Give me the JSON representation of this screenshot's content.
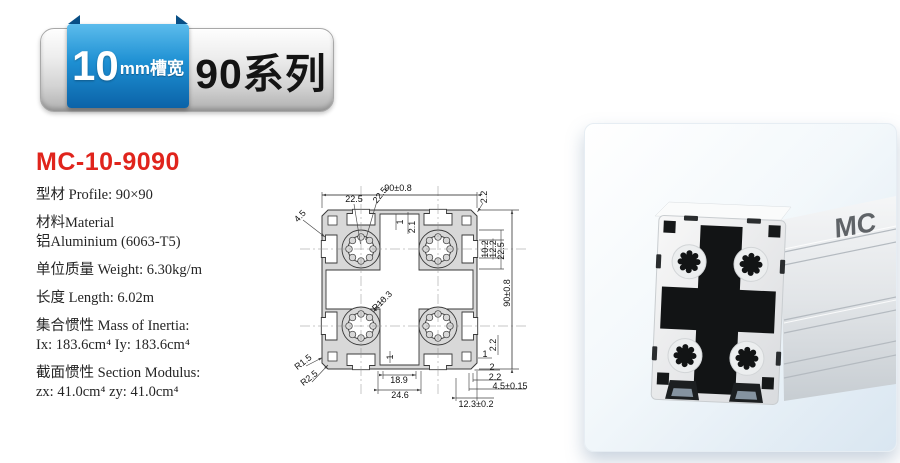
{
  "header": {
    "slot_badge": {
      "number": "10",
      "suffix": "mm槽宽"
    },
    "series": "90系列"
  },
  "product": {
    "model": "MC-10-9090",
    "specs": [
      {
        "lines": [
          "型材 Profile: 90×90"
        ]
      },
      {
        "lines": [
          "材料Material",
          "铝Aluminium (6063-T5)"
        ]
      },
      {
        "lines": [
          "单位质量 Weight: 6.30kg/m"
        ]
      },
      {
        "lines": [
          "长度 Length: 6.02m"
        ]
      },
      {
        "lines": [
          "集合惯性 Mass of Inertia:",
          "Ix: 183.6cm⁴  Iy: 183.6cm⁴"
        ]
      },
      {
        "lines": [
          "截面惯性 Section Modulus:",
          "zx: 41.0cm⁴  zy: 41.0cm⁴"
        ]
      }
    ]
  },
  "drawing": {
    "dimensions": [
      {
        "text": "90±0.8",
        "x": 110,
        "y": 20,
        "rot": 0
      },
      {
        "text": "22.5",
        "x": 66,
        "y": 31,
        "rot": 0
      },
      {
        "text": "22.5",
        "x": 92,
        "y": 27,
        "rot": -52
      },
      {
        "text": "4.5",
        "x": 12,
        "y": 48,
        "rot": -47
      },
      {
        "text": "2.2",
        "x": 196,
        "y": 29,
        "rot": -90
      },
      {
        "text": "1",
        "x": 112,
        "y": 54,
        "rot": -90
      },
      {
        "text": "2.1",
        "x": 124,
        "y": 59,
        "rot": -90
      },
      {
        "text": "10.2",
        "x": 197,
        "y": 81,
        "rot": -90
      },
      {
        "text": "12.2",
        "x": 205,
        "y": 81,
        "rot": -90
      },
      {
        "text": "22.5",
        "x": 213,
        "y": 83,
        "rot": -90
      },
      {
        "text": "90±0.8",
        "x": 219,
        "y": 125,
        "rot": -90
      },
      {
        "text": "R10.3",
        "x": 94,
        "y": 133,
        "rot": -45
      },
      {
        "text": "1",
        "x": 102,
        "y": 189,
        "rot": -90
      },
      {
        "text": "R1.5",
        "x": 15,
        "y": 194,
        "rot": -38
      },
      {
        "text": "R2.5",
        "x": 21,
        "y": 210,
        "rot": -38
      },
      {
        "text": "18.9",
        "x": 111,
        "y": 212,
        "rot": 0
      },
      {
        "text": "24.6",
        "x": 112,
        "y": 227,
        "rot": 0
      },
      {
        "text": "2.2",
        "x": 205,
        "y": 177,
        "rot": -90
      },
      {
        "text": "1",
        "x": 197,
        "y": 186,
        "rot": 0
      },
      {
        "text": "2",
        "x": 204,
        "y": 199,
        "rot": 0
      },
      {
        "text": "2.2",
        "x": 207,
        "y": 209,
        "rot": 0
      },
      {
        "text": "4.5±0.15",
        "x": 222,
        "y": 218,
        "rot": 0
      },
      {
        "text": "12.3±0.2",
        "x": 188,
        "y": 236,
        "rot": 0
      }
    ]
  },
  "photo": {
    "logo": "MC"
  },
  "colors": {
    "model_red": "#e0241c",
    "ribbon_blue": "#1286c9",
    "ribbon_blue_dark": "#0b63a8",
    "badge_silver": "#d3d3d3",
    "photo_bg_blue": "#d9e6f1"
  }
}
